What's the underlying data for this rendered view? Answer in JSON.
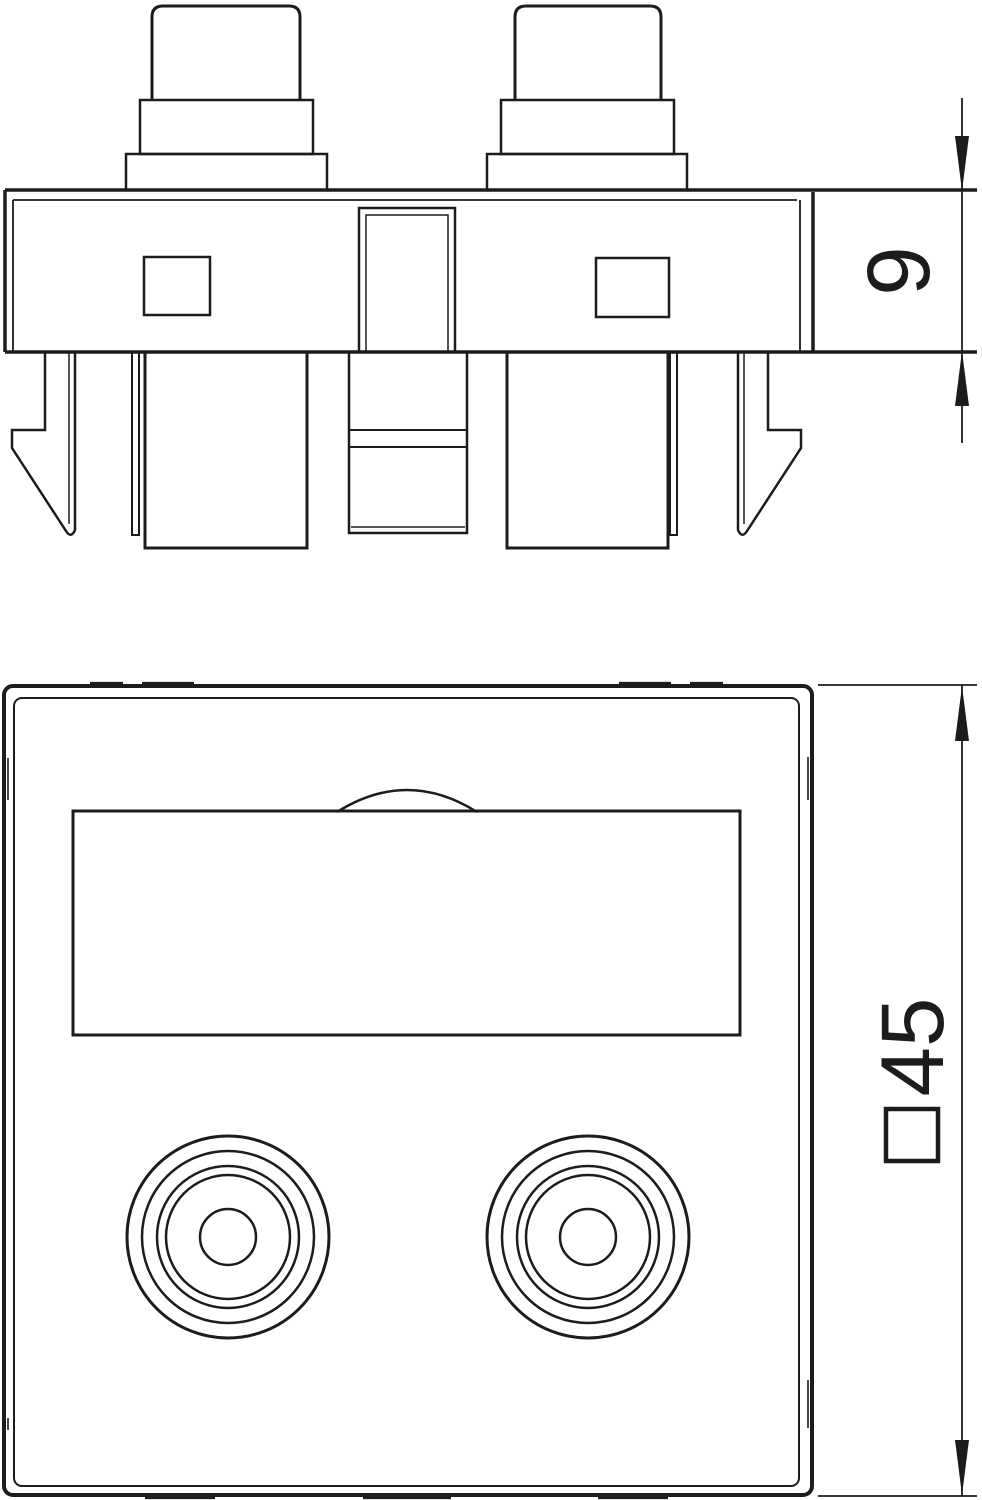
{
  "page": {
    "background": "#ffffff",
    "line_color": "#1c1c1c"
  },
  "dimensions": {
    "module_height": {
      "text": "9",
      "unit_implied": "mm"
    },
    "plate_size": {
      "symbol": "□",
      "text": "45",
      "unit_implied": "mm"
    }
  }
}
